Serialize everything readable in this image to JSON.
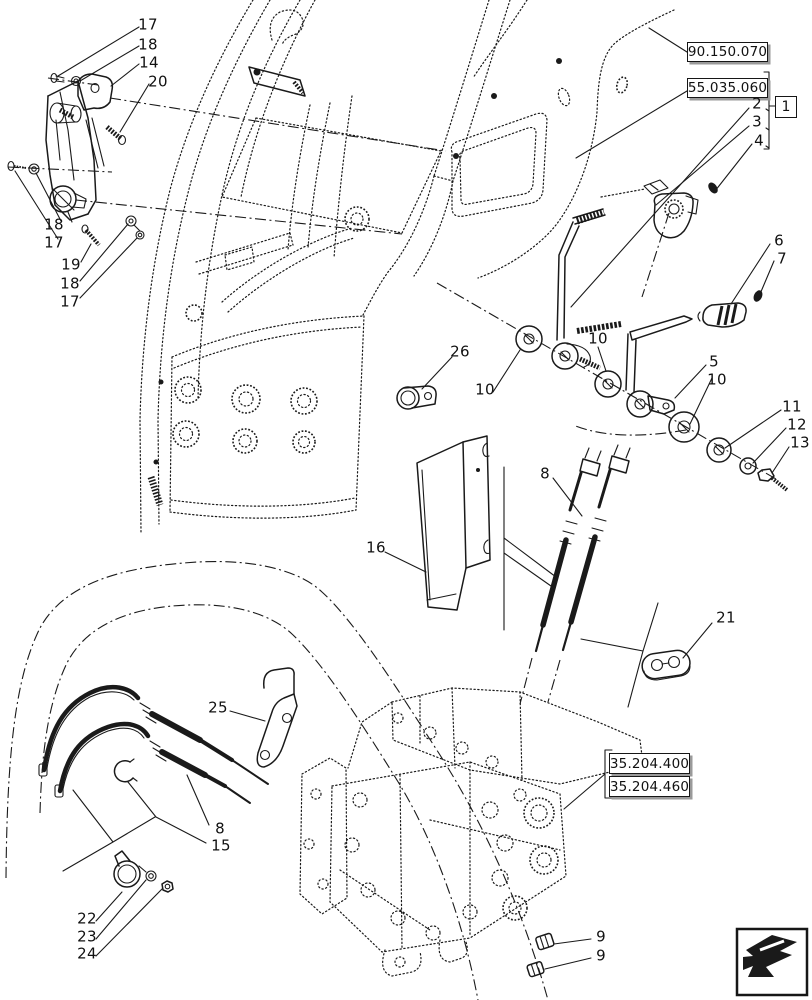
{
  "figure": {
    "type": "exploded-parts-diagram",
    "subject": "cab remote control valve levers and cables",
    "colors": {
      "line": "#1a1a1a",
      "background": "#ffffff",
      "box_shadow": "#9a9a9a"
    }
  },
  "reference_boxes": [
    {
      "label": "90.150.070"
    },
    {
      "label": "55.035.060"
    },
    {
      "label": "35.204.400"
    },
    {
      "label": "35.204.460"
    }
  ],
  "group_box": {
    "label": "1"
  },
  "callouts": [
    {
      "label": "17",
      "x": 148,
      "y": 25
    },
    {
      "label": "18",
      "x": 148,
      "y": 45
    },
    {
      "label": "14",
      "x": 149,
      "y": 63
    },
    {
      "label": "20",
      "x": 158,
      "y": 82
    },
    {
      "label": "18",
      "x": 54,
      "y": 225
    },
    {
      "label": "17",
      "x": 54,
      "y": 243
    },
    {
      "label": "19",
      "x": 71,
      "y": 265
    },
    {
      "label": "18",
      "x": 70,
      "y": 284
    },
    {
      "label": "17",
      "x": 70,
      "y": 302
    },
    {
      "label": "2",
      "x": 757,
      "y": 104
    },
    {
      "label": "3",
      "x": 757,
      "y": 122
    },
    {
      "label": "4",
      "x": 759,
      "y": 141
    },
    {
      "label": "6",
      "x": 779,
      "y": 241
    },
    {
      "label": "7",
      "x": 782,
      "y": 259
    },
    {
      "label": "10",
      "x": 598,
      "y": 339
    },
    {
      "label": "26",
      "x": 460,
      "y": 352
    },
    {
      "label": "5",
      "x": 714,
      "y": 362
    },
    {
      "label": "10",
      "x": 717,
      "y": 380
    },
    {
      "label": "10",
      "x": 485,
      "y": 390
    },
    {
      "label": "11",
      "x": 792,
      "y": 407
    },
    {
      "label": "12",
      "x": 797,
      "y": 425
    },
    {
      "label": "13",
      "x": 800,
      "y": 443
    },
    {
      "label": "8",
      "x": 545,
      "y": 474
    },
    {
      "label": "16",
      "x": 376,
      "y": 548
    },
    {
      "label": "21",
      "x": 726,
      "y": 618
    },
    {
      "label": "25",
      "x": 218,
      "y": 708
    },
    {
      "label": "8",
      "x": 220,
      "y": 829
    },
    {
      "label": "15",
      "x": 221,
      "y": 846
    },
    {
      "label": "22",
      "x": 87,
      "y": 919
    },
    {
      "label": "23",
      "x": 87,
      "y": 937
    },
    {
      "label": "24",
      "x": 87,
      "y": 954
    },
    {
      "label": "9",
      "x": 601,
      "y": 937
    },
    {
      "label": "9",
      "x": 601,
      "y": 956
    }
  ],
  "nav_icon": {
    "name": "prev-page-arrow"
  }
}
